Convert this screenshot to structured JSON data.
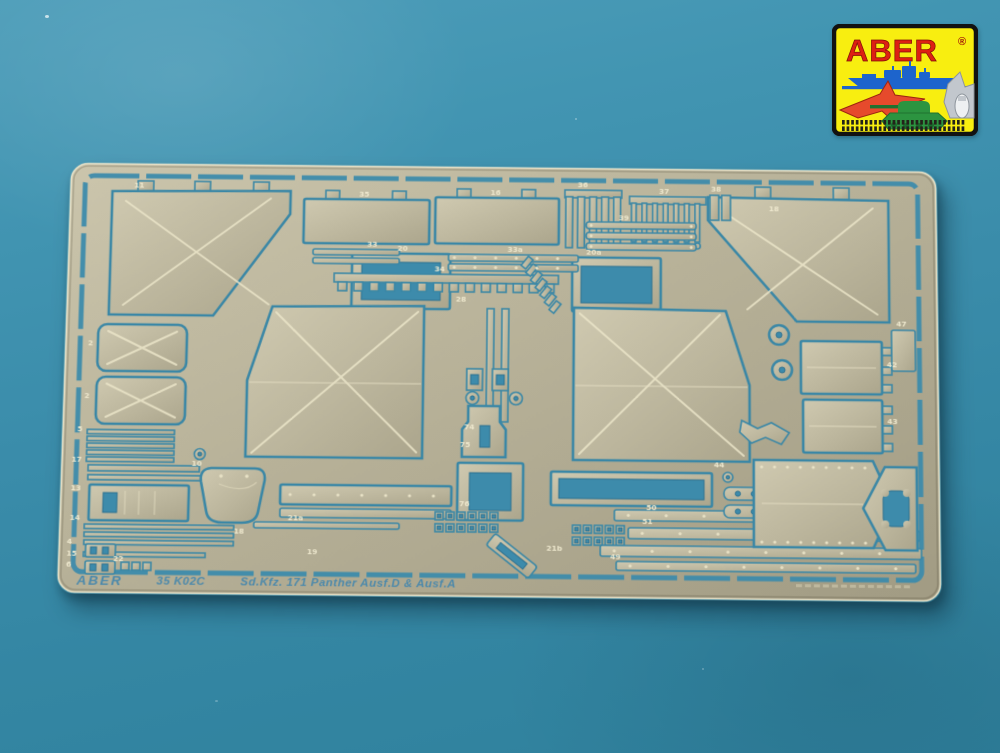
{
  "photo": {
    "background_top_color": "#4d9db9",
    "background_bottom_color": "#2f7f9b"
  },
  "logo": {
    "brand": "ABER",
    "registered_mark": "®",
    "background_color": "#f8ee10",
    "border_color": "#121212",
    "brand_color": "#dd2013",
    "ship_color": "#1d64cc",
    "jet_color": "#e64a2c",
    "tank_color": "#2c9440",
    "plane_color": "#c2c7cd"
  },
  "fret": {
    "brand_text": "ABER",
    "set_number": "35 K02C",
    "title_text": "Sd.Kfz. 171 Panther Ausf.D & Ausf.A",
    "brass_color": "#b8b299",
    "etched_color": "#3d8bab",
    "crease_color": "#ebe5c9",
    "part_labels": [
      {
        "t": "11",
        "x": 66,
        "y": 26
      },
      {
        "t": "35",
        "x": 296,
        "y": 33
      },
      {
        "t": "16",
        "x": 430,
        "y": 30
      },
      {
        "t": "36",
        "x": 519,
        "y": 21
      },
      {
        "t": "37",
        "x": 602,
        "y": 27
      },
      {
        "t": "38",
        "x": 655,
        "y": 24
      },
      {
        "t": "18",
        "x": 714,
        "y": 44
      },
      {
        "t": "39",
        "x": 561,
        "y": 55
      },
      {
        "t": "33",
        "x": 305,
        "y": 85
      },
      {
        "t": "33a",
        "x": 448,
        "y": 89
      },
      {
        "t": "20",
        "x": 336,
        "y": 89
      },
      {
        "t": "20a",
        "x": 528,
        "y": 91
      },
      {
        "t": "34",
        "x": 374,
        "y": 110
      },
      {
        "t": "28",
        "x": 396,
        "y": 141
      },
      {
        "t": "2",
        "x": 24,
        "y": 190
      },
      {
        "t": "2",
        "x": 22,
        "y": 244
      },
      {
        "t": "5",
        "x": 16,
        "y": 278
      },
      {
        "t": "17",
        "x": 11,
        "y": 309
      },
      {
        "t": "13",
        "x": 11,
        "y": 338
      },
      {
        "t": "14",
        "x": 11,
        "y": 368
      },
      {
        "t": "4",
        "x": 9,
        "y": 392
      },
      {
        "t": "15",
        "x": 9,
        "y": 404
      },
      {
        "t": "6",
        "x": 9,
        "y": 415
      },
      {
        "t": "22",
        "x": 56,
        "y": 409
      },
      {
        "t": "10",
        "x": 132,
        "y": 312
      },
      {
        "t": "18",
        "x": 176,
        "y": 380
      },
      {
        "t": "19",
        "x": 250,
        "y": 400
      },
      {
        "t": "74",
        "x": 406,
        "y": 272
      },
      {
        "t": "75",
        "x": 402,
        "y": 290
      },
      {
        "t": "76",
        "x": 402,
        "y": 350
      },
      {
        "t": "21a",
        "x": 230,
        "y": 366
      },
      {
        "t": "21b",
        "x": 490,
        "y": 394
      },
      {
        "t": "49",
        "x": 554,
        "y": 402
      },
      {
        "t": "50",
        "x": 590,
        "y": 352
      },
      {
        "t": "51",
        "x": 586,
        "y": 366
      },
      {
        "t": "44",
        "x": 658,
        "y": 308
      },
      {
        "t": "42",
        "x": 833,
        "y": 204
      },
      {
        "t": "43",
        "x": 833,
        "y": 262
      },
      {
        "t": "47",
        "x": 843,
        "y": 162
      }
    ]
  }
}
